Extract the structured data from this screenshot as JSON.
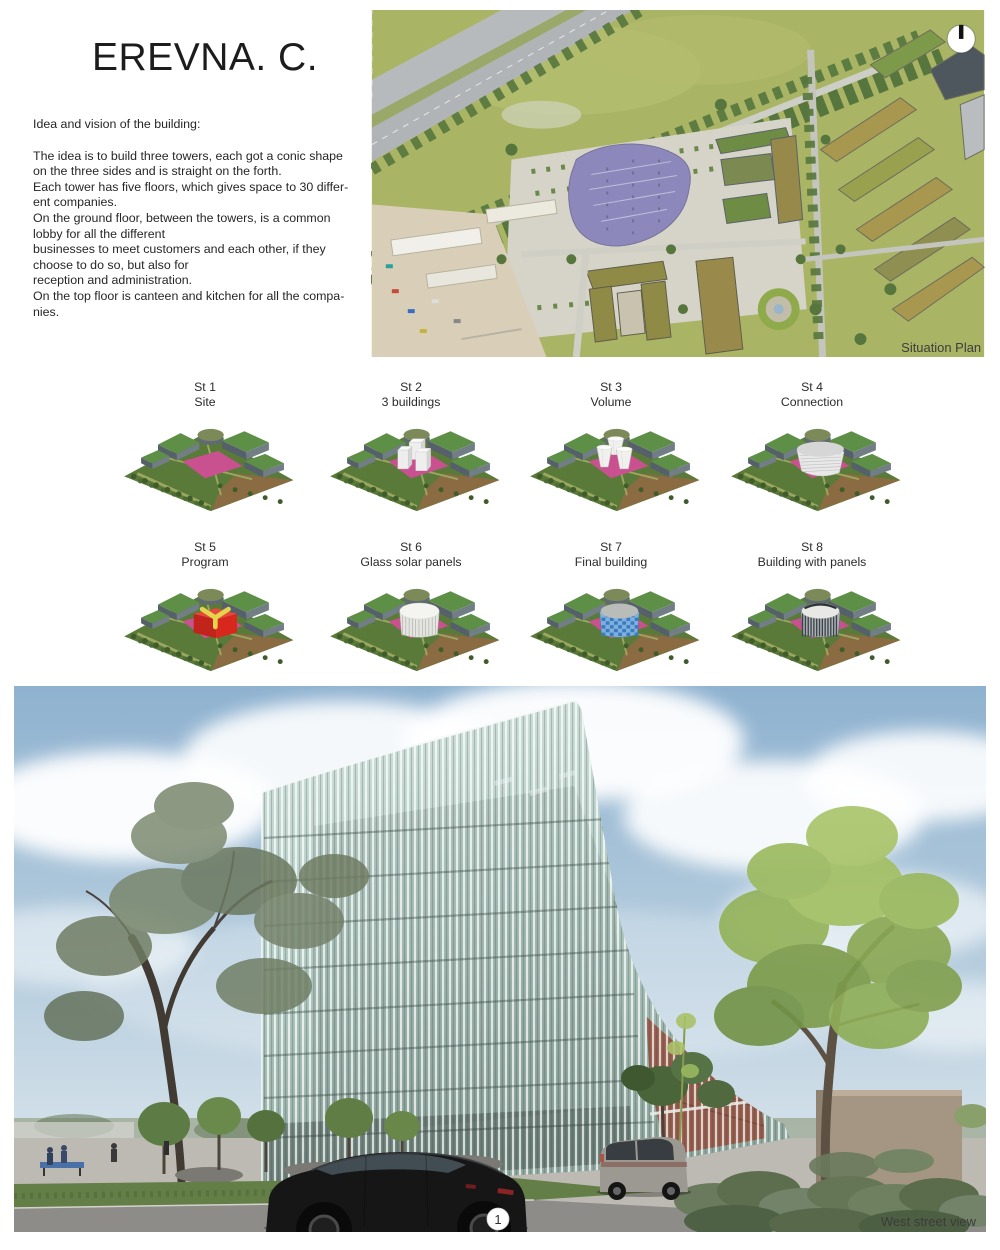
{
  "header": {
    "title": "EREVNA. C.",
    "intro_heading": "Idea and vision of the building:",
    "intro_body": "The idea is to build three towers, each got a conic shape\non the three sides and is straight on the forth.\nEach tower has five floors, which gives space to 30 differ-\nent companies.\nOn the ground floor, between the towers, is a common\nlobby for all the different\nbusinesses to meet customers and each other, if they\nchoose to do so, but also for\nreception and administration.\nOn the top floor is canteen and kitchen for all the compa-\nnies."
  },
  "situation_plan": {
    "caption": "Situation Plan"
  },
  "steps": [
    {
      "id": "St 1",
      "label": "Site",
      "motif": "site"
    },
    {
      "id": "St 2",
      "label": "3 buildings",
      "motif": "boxes"
    },
    {
      "id": "St 3",
      "label": "Volume",
      "motif": "cones"
    },
    {
      "id": "St 4",
      "label": "Connection",
      "motif": "merged"
    },
    {
      "id": "St 5",
      "label": "Program",
      "motif": "program"
    },
    {
      "id": "St 6",
      "label": "Glass solar panels",
      "motif": "glass"
    },
    {
      "id": "St 7",
      "label": "Final building",
      "motif": "final"
    },
    {
      "id": "St 8",
      "label": "Building with panels",
      "motif": "panels"
    }
  ],
  "street_view": {
    "caption": "West street view",
    "marker_label": "1"
  },
  "colors": {
    "site_pink": "#c9518f",
    "site_green": "#5a7a3a",
    "site_brown": "#8a6b42",
    "roof_green": "#5e8f46",
    "building_gray": "#6b7880",
    "program_red": "#d8281e",
    "program_yellow": "#e3d34d",
    "final_glass_blue": "#3a7abf",
    "panel_dark": "#3c4248",
    "caption_gray": "#3d3d3d"
  }
}
